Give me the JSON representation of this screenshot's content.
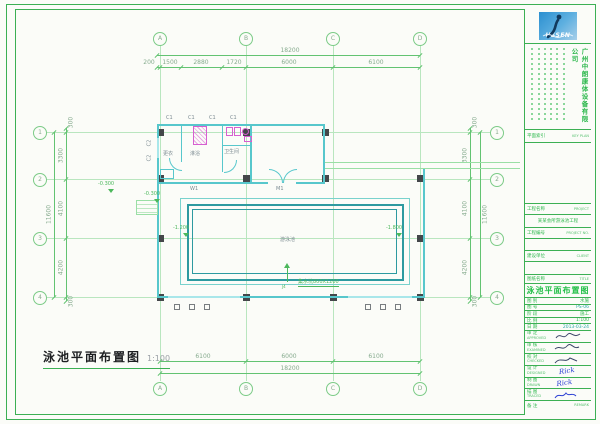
{
  "caption": {
    "text": "泳池平面布置图",
    "scale": "1:100"
  },
  "axes": {
    "cols": [
      "A",
      "B",
      "C",
      "D"
    ],
    "rows": [
      "1",
      "2",
      "3",
      "4"
    ]
  },
  "dims": {
    "top_total": "18200",
    "top_subs": [
      "200",
      "1500",
      "2880",
      "1720",
      "6000",
      "6100"
    ],
    "bottom_subs": [
      "6100",
      "6000",
      "6100"
    ],
    "bottom_total": "18200",
    "side_total": "11600",
    "side_subs": [
      "300",
      "3300",
      "4100",
      "4200",
      "300"
    ]
  },
  "plan": {
    "pool_label": "游泳池",
    "levels": {
      "deck_a": "-0.300",
      "deck_b": "-0.300",
      "shallow": "-1.200",
      "deep": "-1.800"
    },
    "sump_note": "集水坑800X1200",
    "drain_label": "J4",
    "rooms": [
      "更衣",
      "淋浴",
      "卫生间"
    ],
    "door_label": "M1",
    "wall_label": "W1",
    "window_label": "C1",
    "side_window_label": "C2"
  },
  "titleblock": {
    "logo_text": "USSEN",
    "company": "广州中朗康体设备有限公司",
    "key_plan": {
      "cn": "平面索引",
      "en": "KEY PLAN"
    },
    "project": {
      "cn": "工程名称",
      "en": "PROJECT",
      "value": "某某会所游泳池工程"
    },
    "project_no": {
      "cn": "工程编号",
      "en": "PROJECT NO."
    },
    "client": {
      "cn": "建设单位",
      "en": "CLIENT"
    },
    "sheet_name": {
      "cn": "图纸名称",
      "en": "TITLE",
      "value": "泳池平面布置图"
    },
    "meta": [
      {
        "label": "图 别",
        "value": "水施"
      },
      {
        "label": "图 号",
        "value": "PS-06"
      },
      {
        "label": "阶 段",
        "value": "施工"
      },
      {
        "label": "比 例",
        "value": "1:100"
      },
      {
        "label": "日 期",
        "value": "2013-03-24"
      }
    ],
    "signs": [
      {
        "label": "审 定",
        "en": "APPROVED",
        "value": ""
      },
      {
        "label": "审 核",
        "en": "EXAMINED",
        "value": ""
      },
      {
        "label": "校 对",
        "en": "CHECKED",
        "value": ""
      },
      {
        "label": "设 计",
        "en": "DESIGNED",
        "value": "Rick"
      },
      {
        "label": "制 图",
        "en": "DRAWN",
        "value": "Rick"
      },
      {
        "label": "描 图",
        "en": "TRACED",
        "value": ""
      }
    ],
    "remark": {
      "cn": "备 注",
      "en": "REMARK"
    }
  }
}
